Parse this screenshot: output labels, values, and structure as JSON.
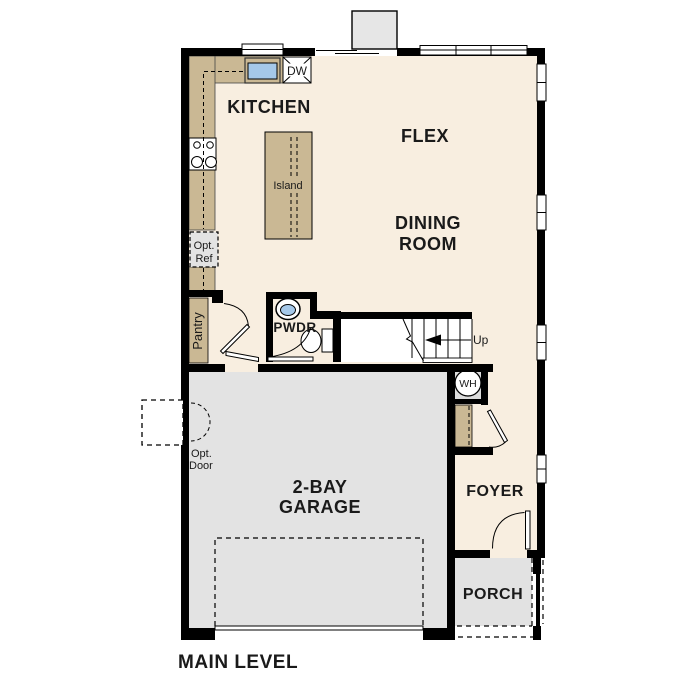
{
  "title": {
    "label": "MAIN LEVEL"
  },
  "colors": {
    "wall": "#000000",
    "floor": "#f8eee0",
    "counter": "#cab894",
    "garage": "#e3e3e3",
    "porch": "#e2e2e2",
    "chimney": "#e6e6e6",
    "stairwell": "#ffffff",
    "window_fill": "#ffffff",
    "sink_blue": "#a5c8e9",
    "opt_ref_fill": "#e3e3e3",
    "wh_fill": "#dcdcdc",
    "text": "#1a1a1a"
  },
  "rooms": {
    "kitchen": {
      "label": "KITCHEN"
    },
    "flex": {
      "label": "FLEX"
    },
    "dining": {
      "line1": "DINING",
      "line2": "ROOM"
    },
    "garage": {
      "line1": "2-BAY",
      "line2": "GARAGE"
    },
    "foyer": {
      "label": "FOYER"
    },
    "porch": {
      "label": "PORCH"
    },
    "powder": {
      "label": "PWDR"
    },
    "pantry": {
      "label": "Pantry"
    }
  },
  "fixtures": {
    "island": {
      "label": "Island"
    },
    "dishwasher": {
      "label": "DW"
    },
    "water_heater": {
      "label": "WH"
    },
    "opt_ref": {
      "line1": "Opt.",
      "line2": "Ref"
    },
    "opt_door": {
      "line1": "Opt.",
      "line2": "Door"
    },
    "stairs": {
      "label": "Up"
    }
  }
}
